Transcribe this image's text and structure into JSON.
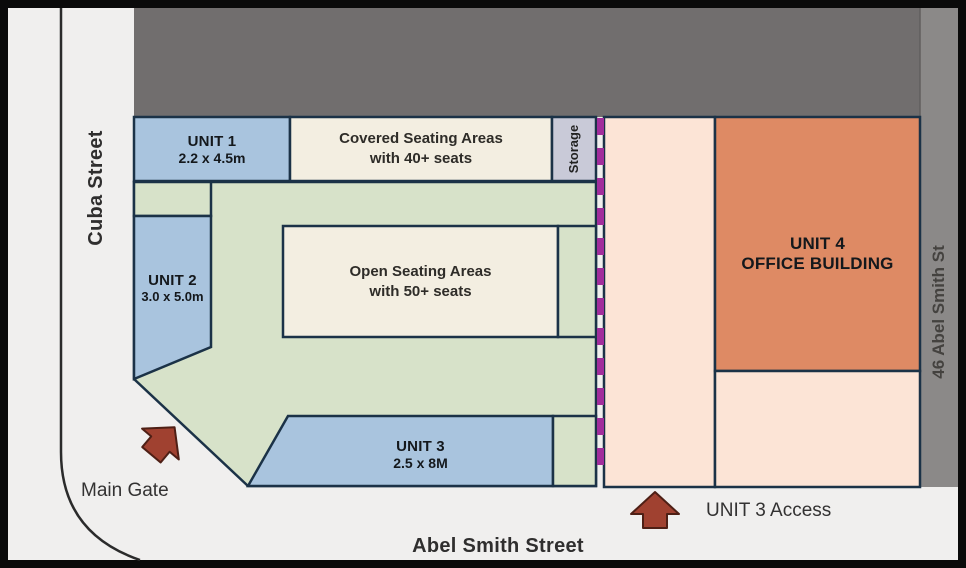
{
  "colors": {
    "street": "#f0efee",
    "road_line": "#2b2b2b",
    "building_gray": "#716e6e",
    "neighbor_gray": "#8b8988",
    "unit_blue": "#a9c4de",
    "lawn_green": "#d7e2c9",
    "seating_cream": "#f3eee1",
    "storage_lavender": "#c9cad8",
    "boundary_navy": "#1b3247",
    "lot_peach": "#fce4d6",
    "office_orange": "#de8a64",
    "gate_purple": "#a12d9c",
    "arrow_red": "#a04130",
    "text_dark": "#2f2e2e"
  },
  "streets": {
    "left": "Cuba Street",
    "bottom": "Abel Smith Street",
    "right": "46 Abel Smith St"
  },
  "areas": {
    "unit1": {
      "name": "UNIT 1",
      "dims": "2.2 x 4.5m"
    },
    "unit2": {
      "name": "UNIT 2",
      "dims": "3.0 x 5.0m"
    },
    "unit3": {
      "name": "UNIT 3",
      "dims": "2.5 x 8M"
    },
    "unit4": {
      "name": "UNIT 4",
      "type": "OFFICE BUILDING"
    },
    "covered_seating": {
      "line1": "Covered Seating Areas",
      "line2": "with 40+ seats"
    },
    "open_seating": {
      "line1": "Open Seating Areas",
      "line2": "with 50+ seats"
    },
    "storage": {
      "label": "Storage"
    }
  },
  "annotations": {
    "main_gate": "Main Gate",
    "unit3_access": "UNIT 3 Access"
  }
}
